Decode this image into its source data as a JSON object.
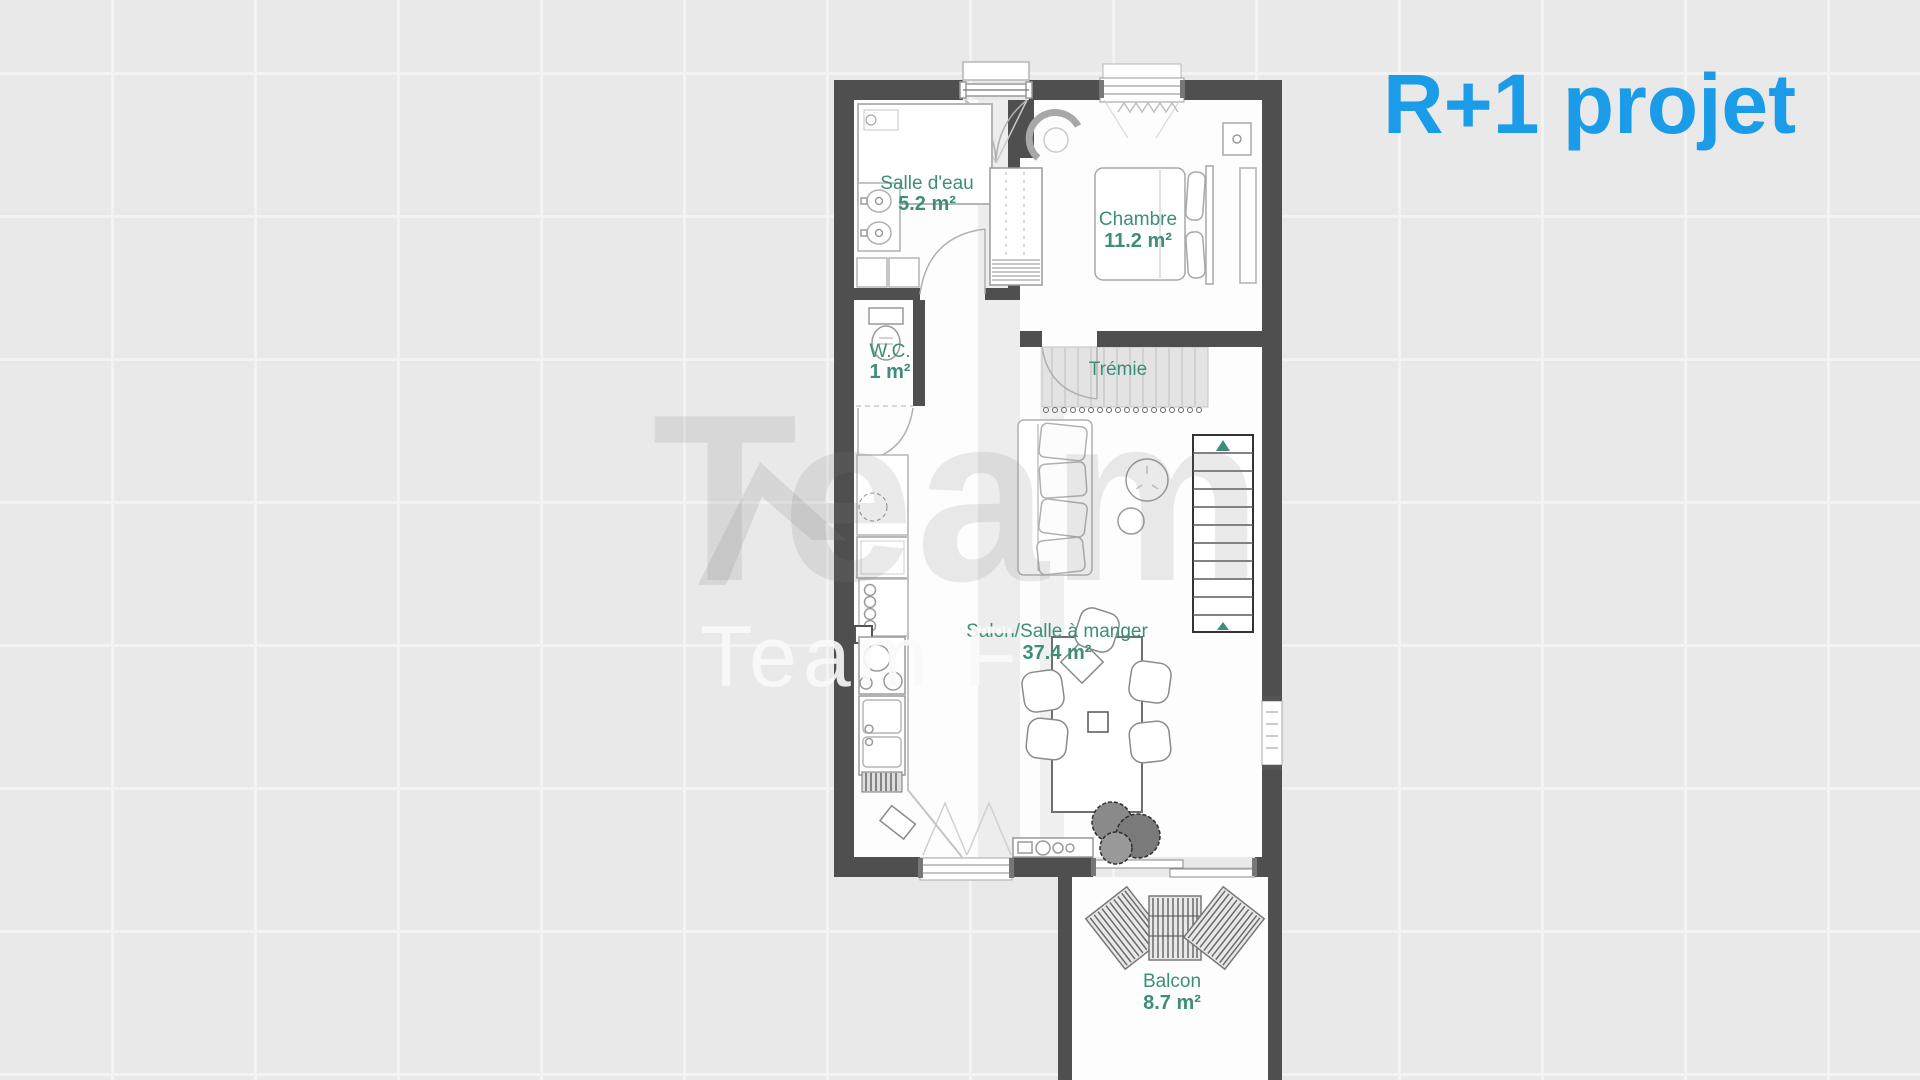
{
  "title": {
    "text": "R+1 projet"
  },
  "watermark": {
    "large": "Team",
    "small": "Team F"
  },
  "colors": {
    "title_accent": "#1b9ce8",
    "room_label": "#3d8d7a",
    "wall": "#4f4f4f",
    "background": "#e9e9e9",
    "grid_line": "#f3f3f3"
  },
  "rooms": [
    {
      "name": "Salle d'eau",
      "area": "5.2 m²"
    },
    {
      "name": "W.C.",
      "area": "1 m²"
    },
    {
      "name": "Chambre",
      "area": "11.2 m²"
    },
    {
      "name": "Trémie",
      "area": ""
    },
    {
      "name": "Salon/Salle à manger",
      "area": "37.4 m²"
    },
    {
      "name": "Balcon",
      "area": "8.7 m²"
    }
  ]
}
